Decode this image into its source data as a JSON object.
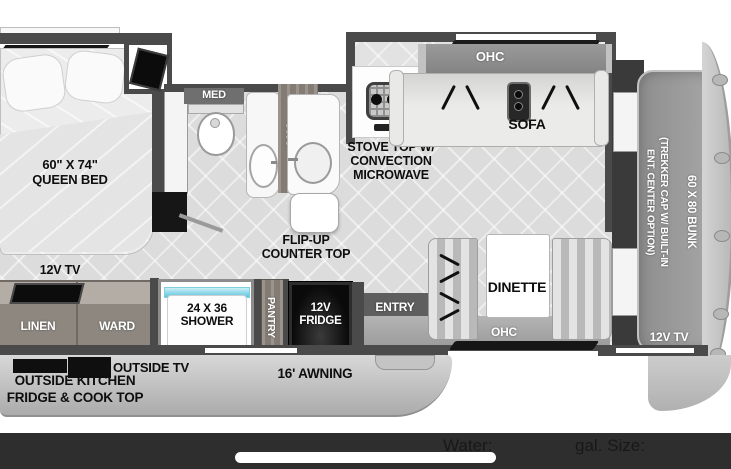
{
  "top_label": "TREKKER SEAT",
  "labels": {
    "queen_bed": "60\" X 74\"\nQUEEN BED",
    "bed_tv": "12V TV",
    "med": "MED",
    "bath_ohc": "OHC",
    "stove": "STOVE TOP W/\nCONVECTION\nMICROWAVE",
    "flip_up": "FLIP-UP\nCOUNTER TOP",
    "sofa_ohc": "OHC",
    "sofa": "SOFA",
    "dinette": "DINETTE",
    "dinette_ohc": "OHC",
    "entry": "ENTRY",
    "bunk": "60 X 80 BUNK",
    "cap": "(TREKKER CAP W/ BUILT-IN\nENT. CENTER OPTION)",
    "front_tv": "12V TV",
    "linen": "LINEN",
    "ward": "WARD",
    "shower": "24 X 36\nSHOWER",
    "pantry": "PANTRY",
    "fridge": "12V\nFRIDGE",
    "outside_tv": "OUTSIDE TV",
    "outside_kitchen": "OUTSIDE KITCHEN\nFRIDGE & COOK TOP",
    "awning": "16' AWNING"
  },
  "status_bar": {
    "water_label": "Water:",
    "size_label": "gal. Size:"
  },
  "colors": {
    "wall": "#4a4a4a",
    "floor": "#dcdcdc",
    "water_accent": "#5bc6de",
    "status_bar_bg": "#2e2e2e",
    "appliance_black": "#111111"
  }
}
